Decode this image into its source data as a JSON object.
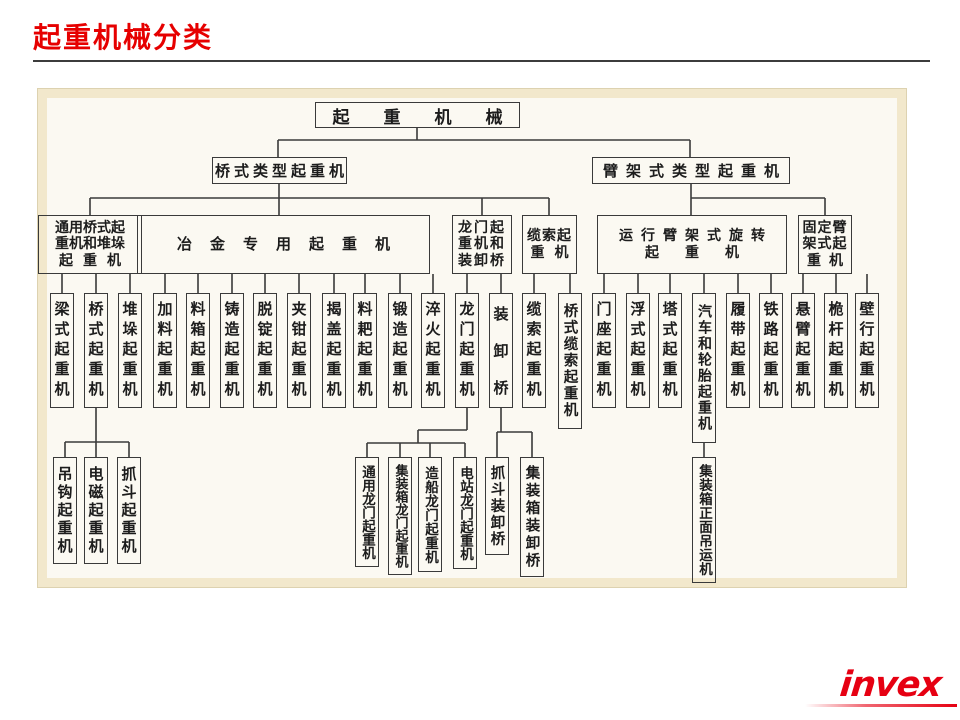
{
  "header": {
    "title": "起重机械分类"
  },
  "footer": {
    "logo": "invex"
  },
  "tree": {
    "root": "起重机械",
    "l1": [
      {
        "label": "桥式类型起重机"
      },
      {
        "label": "臂架式类型起重机"
      }
    ],
    "l2": [
      {
        "lines": [
          "通用桥式起",
          "重机和堆垛",
          "起重机"
        ]
      },
      {
        "lines": [
          "冶金专用起重机"
        ]
      },
      {
        "lines": [
          "龙门起",
          "重机和",
          "装卸桥"
        ]
      },
      {
        "lines": [
          "缆索起",
          "重机"
        ]
      },
      {
        "lines": [
          "运行臂架式旋转",
          "起重机"
        ]
      },
      {
        "lines": [
          "固定臂",
          "架式起",
          "重机"
        ]
      }
    ],
    "l3": [
      "梁式起重机",
      "桥式起重机",
      "堆垛起重机",
      "加料起重机",
      "料箱起重机",
      "铸造起重机",
      "脱锭起重机",
      "夹钳起重机",
      "揭盖起重机",
      "料耙起重机",
      "锻造起重机",
      "淬火起重机",
      "龙门起重机",
      "装卸桥",
      "缆索起重机",
      "桥式缆索起重机",
      "门座起重机",
      "浮式起重机",
      "塔式起重机",
      "汽车和轮胎起重机",
      "履带起重机",
      "铁路起重机",
      "悬臂起重机",
      "桅杆起重机",
      "壁行起重机"
    ],
    "l4": [
      "吊钩起重机",
      "电磁起重机",
      "抓斗起重机",
      "通用龙门起重机",
      "集装箱龙门起重机",
      "造船龙门起重机",
      "电站龙门起重机",
      "抓斗装卸桥",
      "集装箱装卸桥",
      "集装箱正面吊运机"
    ]
  }
}
